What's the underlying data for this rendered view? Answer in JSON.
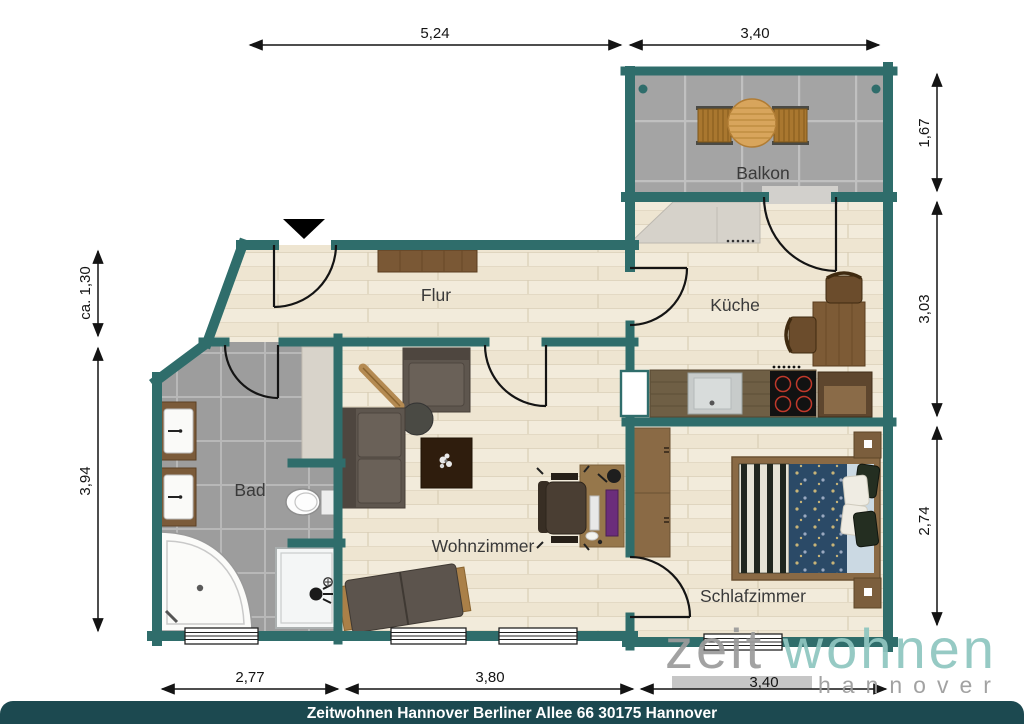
{
  "plan": {
    "rooms": {
      "flur": "Flur",
      "kueche": "Küche",
      "bad": "Bad",
      "wohnzimmer": "Wohnzimmer",
      "schlafzimmer": "Schlafzimmer",
      "balkon": "Balkon"
    },
    "dimensions": {
      "top": [
        "5,24",
        "3,40"
      ],
      "right": [
        "1,67",
        "3,03",
        "2,74"
      ],
      "left": [
        "ca. 1,30",
        "3,94"
      ],
      "bottom": [
        "2,77",
        "3,80",
        "3,40"
      ]
    },
    "colors": {
      "wall": "#2F6D6B",
      "floor_wood": "#F2EBDB",
      "tile_gray": "#9D9D9D",
      "balcony_tile": "#A4A4A4",
      "caption_bar": "#1C4950",
      "logo_gray": "#9C9C9C",
      "logo_teal": "#8FC6C0"
    },
    "furniture_icons": [
      "entrance-arrow-icon",
      "sideboard",
      "washbasin",
      "washbasin",
      "corner-bathtub",
      "shower",
      "toilet",
      "bath-cabinet",
      "sofa",
      "armchair",
      "floor-lamp",
      "coffee-table",
      "rug-with-plant",
      "desk",
      "office-chair",
      "lounger",
      "kitchen-cabinets",
      "kitchen-counter",
      "kitchen-sink",
      "stove",
      "kitchen-side-cabinet",
      "dining-table",
      "dining-chair",
      "dining-chair",
      "wardrobe",
      "double-bed",
      "nightstand",
      "nightstand",
      "balcony-table",
      "balcony-chair",
      "balcony-chair",
      "window",
      "window",
      "window",
      "window",
      "door-arc",
      "door-arc",
      "door-arc",
      "door-arc",
      "door-arc",
      "door-arc"
    ]
  },
  "logo": {
    "word_gray": "zeit",
    "word_teal": "wohnen",
    "city": "hannover"
  },
  "footer": {
    "caption": "Zeitwohnen Hannover Berliner Allee 66 30175 Hannover"
  }
}
